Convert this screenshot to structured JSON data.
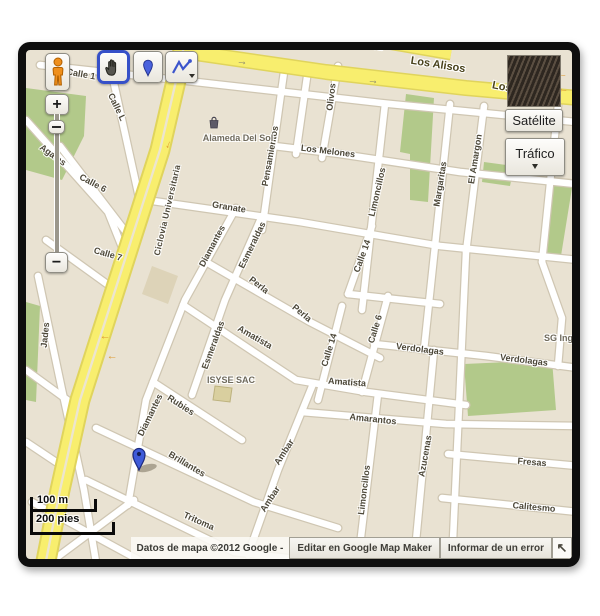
{
  "colors": {
    "map_base": "#e9e2d2",
    "street_fill": "#ffffff",
    "street_casing": "#cfc6b2",
    "highway_fill": "#f8ee6e",
    "highway_casing": "#e0d45c",
    "park_green": "#b2c98a",
    "marker_blue": "#3f5bd9",
    "frame": "#0e0e0e"
  },
  "toolbar": {
    "hand_tool": "pan-hand-tool",
    "marker_tool": "place-marker-tool",
    "line_tool": "draw-line-tool"
  },
  "zoom_control": {
    "zoom_in": "+",
    "zoom_out": "−"
  },
  "layers": {
    "satellite_label": "Satélite",
    "traffic_label": "Tráfico"
  },
  "scale_bar": {
    "metric": "100 m",
    "imperial": "200 pies"
  },
  "attribution": {
    "copyright": "Datos de mapa ©2012 Google -",
    "edit_button": "Editar en Google Map Maker",
    "report_button": "Informar de un error",
    "expand_arrow": "↖"
  },
  "map": {
    "arrow_glyph": "→",
    "labels": [
      {
        "t": "Calle 1",
        "x": 55,
        "y": 24,
        "r": 10
      },
      {
        "t": "Calle L",
        "x": 91,
        "y": 57,
        "r": 64
      },
      {
        "t": "Agatas",
        "x": 27,
        "y": 105,
        "r": 36
      },
      {
        "t": "Calle 6",
        "x": 67,
        "y": 133,
        "r": 28
      },
      {
        "t": "Calle 7",
        "x": 82,
        "y": 204,
        "r": 16
      },
      {
        "t": "Jades",
        "x": 19,
        "y": 285,
        "r": -84
      },
      {
        "t": "Ciclovia Universitaria",
        "x": 141,
        "y": 160,
        "r": -77,
        "c": "sm"
      },
      {
        "t": "Granate",
        "x": 203,
        "y": 157,
        "r": 9
      },
      {
        "t": "Diamantes",
        "x": 186,
        "y": 196,
        "r": -62
      },
      {
        "t": "Esmeraldas",
        "x": 226,
        "y": 195,
        "r": -64
      },
      {
        "t": "Pensamientos",
        "x": 244,
        "y": 106,
        "r": -80
      },
      {
        "t": "Olivos",
        "x": 305,
        "y": 47,
        "r": -83
      },
      {
        "t": "Los Melones",
        "x": 302,
        "y": 101,
        "r": 7
      },
      {
        "t": "Alameda Del Sol",
        "x": 212,
        "y": 88,
        "r": 0,
        "c": "poi"
      },
      {
        "t": "Limoncillos",
        "x": 351,
        "y": 142,
        "r": -77
      },
      {
        "t": "Margaritas",
        "x": 414,
        "y": 134,
        "r": -81
      },
      {
        "t": "El Amargon",
        "x": 449,
        "y": 109,
        "r": -81
      },
      {
        "t": "Los Alisos",
        "x": 412,
        "y": 15,
        "r": 9,
        "c": "rd"
      },
      {
        "t": "Los A",
        "x": 481,
        "y": 38,
        "r": 11,
        "c": "rd"
      },
      {
        "t": "Alisos",
        "x": 341,
        "y": -5,
        "r": 8,
        "c": "rd"
      },
      {
        "t": "Calle 14",
        "x": 336,
        "y": 206,
        "r": -70
      },
      {
        "t": "Perla",
        "x": 233,
        "y": 235,
        "r": 38
      },
      {
        "t": "Perla",
        "x": 276,
        "y": 263,
        "r": 40
      },
      {
        "t": "Calle 6",
        "x": 349,
        "y": 279,
        "r": -73
      },
      {
        "t": "Calle 14",
        "x": 303,
        "y": 300,
        "r": -73
      },
      {
        "t": "Esmeraldas",
        "x": 187,
        "y": 295,
        "r": -70
      },
      {
        "t": "Amatista",
        "x": 229,
        "y": 287,
        "r": 30
      },
      {
        "t": "Amatista",
        "x": 321,
        "y": 332,
        "r": 4
      },
      {
        "t": "ISYSE SAC",
        "x": 205,
        "y": 330,
        "r": 0,
        "c": "poi"
      },
      {
        "t": "Verdolagas",
        "x": 394,
        "y": 299,
        "r": 7
      },
      {
        "t": "Verdolagas",
        "x": 498,
        "y": 310,
        "r": 7
      },
      {
        "t": "SG Inge",
        "x": 535,
        "y": 288,
        "r": 0,
        "c": "poi"
      },
      {
        "t": "Amarantos",
        "x": 347,
        "y": 369,
        "r": 6
      },
      {
        "t": "Azucenas",
        "x": 399,
        "y": 406,
        "r": -80
      },
      {
        "t": "Ambar",
        "x": 258,
        "y": 402,
        "r": -57
      },
      {
        "t": "Ambar",
        "x": 244,
        "y": 449,
        "r": -57
      },
      {
        "t": "Limoncillos",
        "x": 338,
        "y": 440,
        "r": -83
      },
      {
        "t": "Rubies",
        "x": 155,
        "y": 355,
        "r": 33
      },
      {
        "t": "Diamantes",
        "x": 124,
        "y": 365,
        "r": -64
      },
      {
        "t": "Brillantes",
        "x": 161,
        "y": 414,
        "r": 31
      },
      {
        "t": "Tritoma",
        "x": 173,
        "y": 471,
        "r": 24
      },
      {
        "t": "Fresas",
        "x": 506,
        "y": 412,
        "r": 5
      },
      {
        "t": "Calitesmo",
        "x": 508,
        "y": 457,
        "r": 5
      }
    ],
    "arrows": [
      {
        "x": 216,
        "y": 12,
        "r": 8,
        "c": "gray"
      },
      {
        "x": 347,
        "y": 31,
        "r": 8,
        "c": "gray"
      },
      {
        "x": 536,
        "y": 26,
        "r": 188,
        "c": "orange"
      },
      {
        "x": 537,
        "y": 41,
        "r": 188,
        "c": "orange"
      },
      {
        "x": 143,
        "y": 95,
        "r": 112,
        "c": "orange"
      },
      {
        "x": 79,
        "y": 288,
        "r": 180,
        "c": "orange"
      },
      {
        "x": 86,
        "y": 308,
        "r": 180,
        "c": "orange"
      }
    ]
  }
}
